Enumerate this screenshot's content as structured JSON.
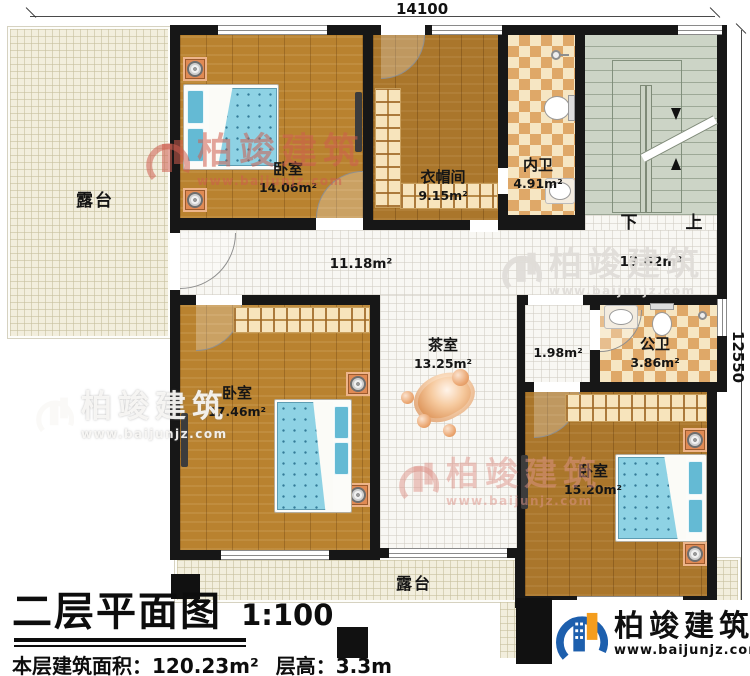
{
  "dimensions": {
    "top": "14100",
    "right": "12550"
  },
  "rooms": {
    "terrace_tl": {
      "name": "露台"
    },
    "bedroom_top": {
      "name": "卧室",
      "area": "14.06m²"
    },
    "cloakroom": {
      "name": "衣帽间",
      "area": "9.15m²"
    },
    "bath_inner": {
      "name": "内卫",
      "area": "4.91m²"
    },
    "stairs": {
      "down": "下",
      "up": "上",
      "area": "13.62m²"
    },
    "hallway": {
      "area": "11.18m²"
    },
    "bedroom_left": {
      "name": "卧室",
      "area": "17.46m²"
    },
    "tearoom": {
      "name": "茶室",
      "area": "13.25m²"
    },
    "hall_small": {
      "area": "1.98m²"
    },
    "bath_public": {
      "name": "公卫",
      "area": "3.86m²"
    },
    "bedroom_right": {
      "name": "卧室",
      "area": "15.20m²"
    },
    "terrace_bottom": {
      "name": "露台"
    }
  },
  "title_block": {
    "title": "二层平面图",
    "scale": "1:100",
    "area_text": "本层建筑面积：120.23m²",
    "height_text": "层高：3.3m"
  },
  "logo": {
    "name": "柏竣建筑",
    "url": "www.baijunjz.com"
  },
  "watermark": {
    "brand": "柏竣建筑",
    "url": "www.baijunjz.com"
  },
  "colors": {
    "brand_blue": "#1d5fad",
    "brand_orange": "#f49d1d",
    "wall": "#171717",
    "watermark_red": "#ce5c4e"
  }
}
